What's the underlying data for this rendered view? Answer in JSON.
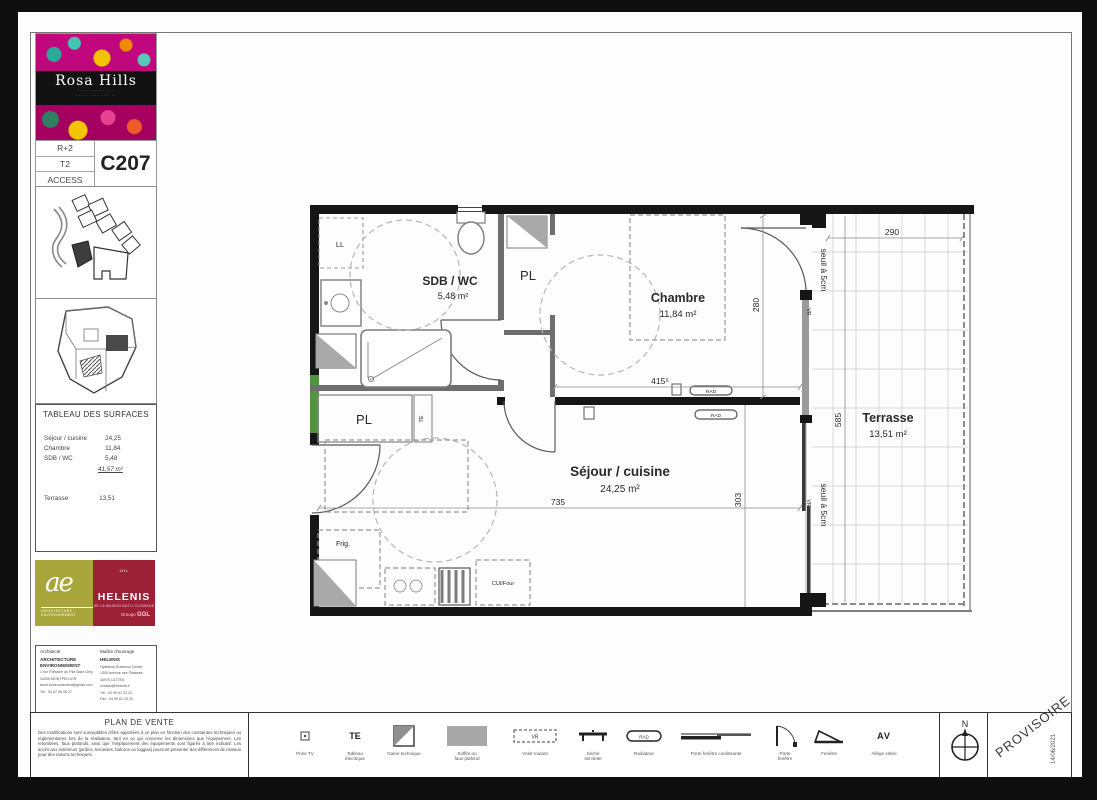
{
  "program": {
    "name": "Rosa Hills",
    "floor": "R+2",
    "type": "T2",
    "access": "ACCESS",
    "unit": "C207"
  },
  "surfaces": {
    "title": "TABLEAU DES SURFACES",
    "rows": [
      {
        "label": "Séjour / cuisine",
        "value": "24,25"
      },
      {
        "label": "Chambre",
        "value": "11,84"
      },
      {
        "label": "SDB / WC",
        "value": "5,48"
      }
    ],
    "total": "41,57 m²",
    "terrace": {
      "label": "Terrasse",
      "value": "13,51"
    }
  },
  "logos": {
    "ae": "ae",
    "ae_sub": "ARCHITECTURE ENVIRONNEMENT",
    "helenis_top": "LHL",
    "helenis": "HELENIS",
    "helenis_sub": "DE LA MAISON BATI L'OUVRAGE",
    "groupe": "Groupe ",
    "groupe_b": "GGL"
  },
  "contacts": {
    "architect": {
      "role": "Architecte",
      "name": "ARCHITECTURE ENVIRONNEMENT",
      "line1": "1 rue Fontaine du Pila Saint Gély",
      "line2": "34000 MONTPELLIER",
      "line3": "archi.environnement@gmail.com",
      "line4": "Tél : 04 67 06 06 27"
    },
    "owner": {
      "role": "Maître d'ouvrage",
      "name": "HELENIS",
      "line1": "Hyatance Business Center",
      "line2": "1300 avenue des Platanes",
      "line3": "34970 LATTES",
      "line4": "contact@helenis.fr",
      "line5": "Tél : 04 99 61 23 23",
      "line6": "Fax : 04 99 61 23 20"
    }
  },
  "notice": {
    "title": "PLAN DE VENTE",
    "body": "Des modifications sont susceptibles d'être apportées à ce plan en fonction des contraintes techniques ou réglementaires lors de la réalisation, tant en ce qui concerne les dimensions que l'équipement. Les retombées, faux plafonds, ainsi que l'emplacement des équipements sont figurés à titre indicatif. Les accès aux extérieurs (jardins, terrasses, balcons ou loggias) pourront présenter des différences de niveaux pour des raisons techniques."
  },
  "legend": {
    "prise_tv": "Prise TV",
    "te_icon": "TE",
    "tableau1": "Tableau",
    "tableau2": "électrique",
    "gaine": "Gaine technique",
    "soffite1": "Soffite ou",
    "soffite2": "faux plafond",
    "vr_icon": "VR",
    "volet": "Volet roulant",
    "seche1": "Sèche",
    "seche2": "serviette",
    "rad_icon": "RAD",
    "radiateur": "Radiateur",
    "pfc": "Porte fenêtre coulissante",
    "pf1": "Porte",
    "pf2": "fenêtre",
    "fenetre": "Fenêtre",
    "av_icon": "AV",
    "allege": "Allège vitrée"
  },
  "stamp": {
    "north": "N",
    "provisoire": "PROVISOIRE",
    "date": "14/06/2021"
  },
  "plan": {
    "sdb_name": "SDB / WC",
    "sdb_area": "5,48 m²",
    "pl1": "PL",
    "pl2": "PL",
    "chambre_name": "Chambre",
    "chambre_area": "11,84 m²",
    "sejour_name": "Séjour / cuisine",
    "sejour_area": "24,25 m²",
    "terrasse_name": "Terrasse",
    "terrasse_area": "13,51 m²",
    "ll": "LL",
    "frig": "Frig.",
    "cui": "CUI/Four",
    "te": "TE",
    "rad1": "RAD",
    "rad2": "RAD",
    "vr1": "VR",
    "vr2": "VR",
    "seuil1": "seuil à 5cm",
    "seuil2": "seuil à 5cm",
    "dim_chambre_w": "415⁵",
    "dim_chambre_h": "280",
    "dim_sejour_w": "735",
    "dim_sejour_h": "303",
    "dim_terrasse_w": "290",
    "dim_terrasse_h": "585"
  }
}
